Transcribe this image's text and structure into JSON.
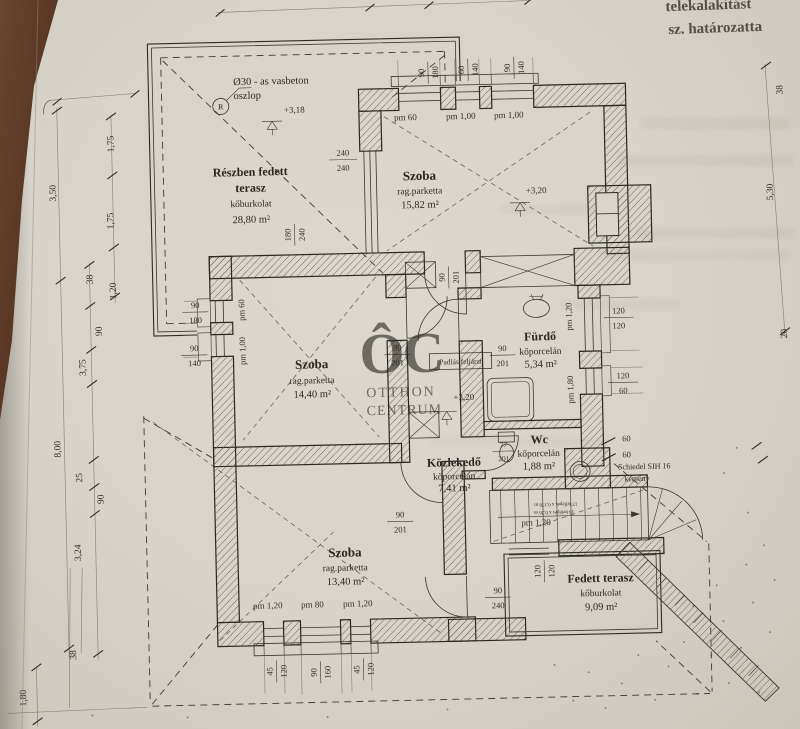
{
  "bleed": {
    "line1": "telekalakítást",
    "line2": "sz. határozatta"
  },
  "watermark": {
    "logo": "ÔC",
    "line1": "OTTHON",
    "line2": "CENTRUM"
  },
  "rooms": {
    "terasz_felso": {
      "name1": "Részben fedett",
      "name2": "terasz",
      "material": "kőburkolat",
      "area": "28,80 m²"
    },
    "szoba_felso": {
      "name": "Szoba",
      "material": "rag.parketta",
      "area": "15,82 m²"
    },
    "szoba_kozep": {
      "name": "Szoba",
      "material": "rag.parketta",
      "area": "14,40 m²"
    },
    "furdo": {
      "name": "Fürdő",
      "material": "kőporcelán",
      "area": "5,34 m²"
    },
    "wc": {
      "name": "Wc",
      "material": "kőporcelán",
      "area": "1,88 m²"
    },
    "kozlekedo": {
      "name": "Közlekedő",
      "material": "kőporcelán",
      "area": "7,41 m²"
    },
    "szoba_also": {
      "name": "Szoba",
      "material": "rag.parketta",
      "area": "13,40 m²"
    },
    "terasz_also": {
      "name": "Fedett terasz",
      "material": "kőburkolat",
      "area": "9,09 m²"
    }
  },
  "annotations": {
    "column_line1": "Ø30 - as vasbeton",
    "column_line2": "oszlop",
    "column_mark": "R",
    "level_318": "+3,18",
    "level_320": "+3,20",
    "attic_access": "Padlás feljárat",
    "chimney_line1": "Schiedel SIH 16",
    "chimney_line2": "kémény",
    "stair_line1": "17 fellépés x 0,178 m",
    "stair_line2": "16 belépés x 0,26 m"
  },
  "openings": {
    "top_win1": {
      "w": "90",
      "h": "180"
    },
    "top_win2": {
      "w": "60",
      "h": "140"
    },
    "top_win3": {
      "w": "90",
      "h": "140"
    },
    "terrace_slider": {
      "w": "240",
      "h": "240"
    },
    "terrace_opening": {
      "w": "180",
      "h": "240"
    },
    "west_win1": {
      "w": "90",
      "h": "180"
    },
    "west_win2": {
      "w": "90",
      "h": "140"
    },
    "door_standard": {
      "w": "90",
      "h": "201"
    },
    "door_wc": {
      "w": "77",
      "h": "201"
    },
    "door_terrace": {
      "w": "90",
      "h": "240"
    },
    "east_win1": {
      "w": "120",
      "h": "120"
    },
    "east_win2": {
      "w": "120",
      "h": "60"
    },
    "chimney_dim": {
      "w": "60",
      "h": "60"
    },
    "bottom_win_small": {
      "w": "45",
      "h": "120"
    },
    "bottom_win_mid": {
      "w": "90",
      "h": "160"
    },
    "terrace_win": {
      "w": "120",
      "h": "120"
    }
  },
  "parapets": {
    "p60": "pm 60",
    "p100": "pm 1,00",
    "p120": "pm 1,20",
    "p80": "pm 80",
    "p180": "pm 1,80"
  },
  "dims": {
    "left": [
      "3,50",
      "1,75",
      "1,75",
      "38",
      "1,20",
      "90",
      "3,75",
      "8,00",
      "25",
      "90",
      "3,24",
      "38",
      "1,80"
    ],
    "right": [
      "38",
      "5,30",
      "20"
    ]
  }
}
